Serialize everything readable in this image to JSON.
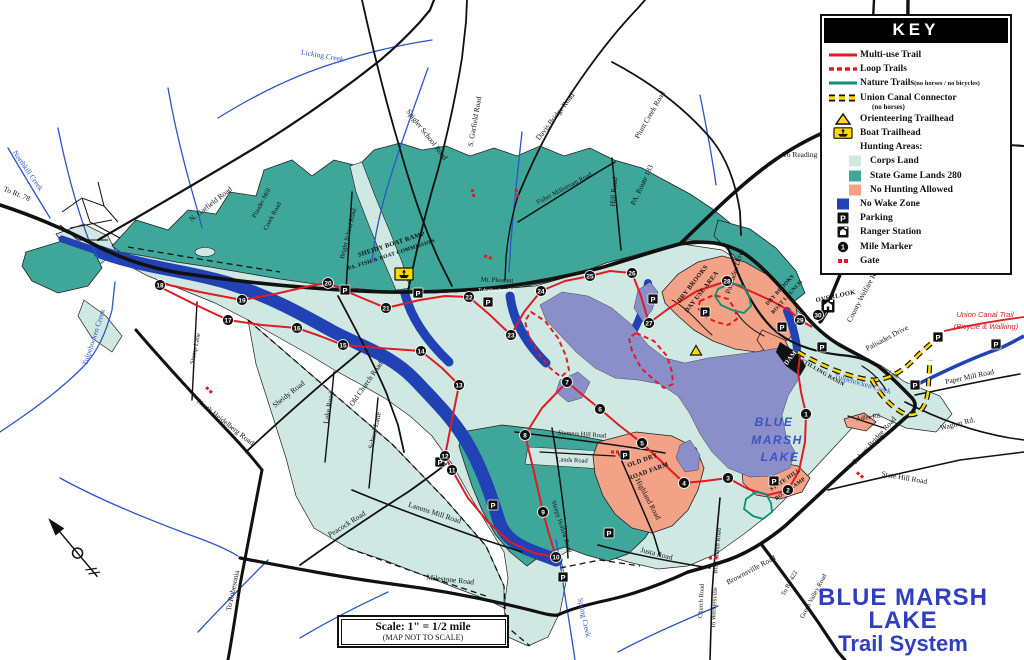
{
  "title": {
    "line1": "BLUE MARSH",
    "line2": "LAKE",
    "line3": "Trail System"
  },
  "scale_box": {
    "line1": "Scale:  1\" = 1/2 mile",
    "line2": "(MAP NOT TO SCALE)"
  },
  "key": {
    "title": "KEY",
    "items": [
      {
        "type": "line-red",
        "label": "Multi-use Trail"
      },
      {
        "type": "line-dash",
        "label": "Loop Trails"
      },
      {
        "type": "line-teal",
        "label": "Nature Trails",
        "note": "(no horses / no bicycles)",
        "note_inline": true
      },
      {
        "type": "line-canal",
        "label": "Union Canal Connector",
        "note": "(no horses)",
        "note_below": true
      },
      {
        "type": "tri",
        "label": "Orienteering Trailhead"
      },
      {
        "type": "boat",
        "label": "Boat Trailhead"
      },
      {
        "type": "none",
        "label": "Hunting Areas:"
      },
      {
        "type": "sw-pale",
        "label": "Corps Land",
        "indent": true
      },
      {
        "type": "sw-teal",
        "label": "State Game Lands 280",
        "indent": true
      },
      {
        "type": "sw-salmon",
        "label": "No Hunting Allowed",
        "indent": true
      },
      {
        "type": "sw-blue",
        "label": "No Wake Zone"
      },
      {
        "type": "parking",
        "label": "Parking"
      },
      {
        "type": "ranger",
        "label": "Ranger Station"
      },
      {
        "type": "mile",
        "label": "Mile Marker"
      },
      {
        "type": "gate",
        "label": "Gate"
      }
    ]
  },
  "colors": {
    "corps_land": "#cfe8e2",
    "state_game_lands": "#3fa79a",
    "no_hunting": "#f2a287",
    "lake": "#8a8fca",
    "no_wake_zone": "#2042b4",
    "creek": "#2b55c8",
    "road": "#111111",
    "multi_use_trail": "#e11b24",
    "nature_trail": "#0d9077",
    "canal_yellow": "#ffd900",
    "title_blue": "#2f3fc0"
  },
  "map": {
    "labels": [
      {
        "t": "To Rt. 78",
        "x": 16,
        "y": 196,
        "r": 22,
        "c": "road"
      },
      {
        "t": "N. Garfield Road",
        "x": 212,
        "y": 206,
        "r": -38,
        "c": "road"
      },
      {
        "t": "Plauder Mill",
        "x": 263,
        "y": 204,
        "r": -62,
        "c": "road",
        "s": 6.5
      },
      {
        "t": "Creek Road",
        "x": 274,
        "y": 217,
        "r": -62,
        "c": "road",
        "s": 6.5
      },
      {
        "t": "Bright School Road",
        "x": 350,
        "y": 234,
        "r": -76,
        "c": "road",
        "s": 6.5
      },
      {
        "t": "Spigler School Road",
        "x": 425,
        "y": 136,
        "r": 52,
        "c": "road"
      },
      {
        "t": "S. Garfield Road",
        "x": 477,
        "y": 122,
        "r": -80,
        "c": "road"
      },
      {
        "t": "Davis Bridge Road",
        "x": 557,
        "y": 118,
        "r": -52,
        "c": "road"
      },
      {
        "t": "Plum Creek Road",
        "x": 652,
        "y": 116,
        "r": -60,
        "c": "road"
      },
      {
        "t": "Fisher Millstream Road",
        "x": 565,
        "y": 190,
        "r": -28,
        "c": "road",
        "s": 6.5
      },
      {
        "t": "Hill Road",
        "x": 616,
        "y": 192,
        "r": -85,
        "c": "road"
      },
      {
        "t": "PA. Route 183",
        "x": 644,
        "y": 186,
        "r": -65,
        "c": "road"
      },
      {
        "t": "To Reading",
        "x": 800,
        "y": 157,
        "r": 0,
        "c": "road"
      },
      {
        "t": "Mt. Pleasant",
        "x": 497,
        "y": 282,
        "r": 2,
        "c": "road",
        "s": 6.5
      },
      {
        "t": "Tulpehocken Rd.",
        "x": 497,
        "y": 292,
        "r": 0,
        "c": "tinyw"
      },
      {
        "t": "Palisades Drive",
        "x": 737,
        "y": 272,
        "r": -72,
        "c": "road"
      },
      {
        "t": "Palisades Drive",
        "x": 888,
        "y": 340,
        "r": -28,
        "c": "road"
      },
      {
        "t": "County Welfare Road",
        "x": 866,
        "y": 294,
        "r": -62,
        "c": "road"
      },
      {
        "t": "Paper Mill Road",
        "x": 970,
        "y": 379,
        "r": -12,
        "c": "road"
      },
      {
        "t": "Sweitzer Lane",
        "x": 884,
        "y": 371,
        "r": 28,
        "c": "road",
        "s": 5.5
      },
      {
        "t": "Wagner Rd.",
        "x": 958,
        "y": 426,
        "r": -14,
        "c": "road"
      },
      {
        "t": "Adler Rd.",
        "x": 869,
        "y": 419,
        "r": -8,
        "c": "road",
        "s": 6.5
      },
      {
        "t": "Rebers Bridge Road",
        "x": 876,
        "y": 442,
        "r": -48,
        "c": "road"
      },
      {
        "t": "State Hill Road",
        "x": 904,
        "y": 480,
        "r": 10,
        "c": "road"
      },
      {
        "t": "Stump Lane",
        "x": 197,
        "y": 349,
        "r": -78,
        "c": "road",
        "s": 6.5
      },
      {
        "t": "Sheidy Road",
        "x": 290,
        "y": 396,
        "r": -38,
        "c": "road"
      },
      {
        "t": "Old Church Road",
        "x": 368,
        "y": 385,
        "r": -55,
        "c": "road"
      },
      {
        "t": "Lake Road",
        "x": 331,
        "y": 408,
        "r": -80,
        "c": "road"
      },
      {
        "t": "School Lane",
        "x": 377,
        "y": 431,
        "r": -78,
        "c": "road"
      },
      {
        "t": "North Heidelberg Road",
        "x": 224,
        "y": 424,
        "r": 38,
        "c": "road"
      },
      {
        "t": "Peacock Road",
        "x": 348,
        "y": 526,
        "r": -32,
        "c": "road"
      },
      {
        "t": "To Robesonia",
        "x": 235,
        "y": 591,
        "r": -78,
        "c": "road"
      },
      {
        "t": "Milestone Road",
        "x": 450,
        "y": 582,
        "r": 6,
        "c": "road"
      },
      {
        "t": "Lamms Mill Road",
        "x": 434,
        "y": 515,
        "r": 18,
        "c": "road"
      },
      {
        "t": "Sleepy Hollow Road",
        "x": 560,
        "y": 527,
        "r": 72,
        "c": "road",
        "s": 6.5
      },
      {
        "t": "Stemers Hill Road",
        "x": 582,
        "y": 436,
        "r": 4,
        "c": "road",
        "s": 6.5
      },
      {
        "t": "Lands Road",
        "x": 572,
        "y": 462,
        "r": 3,
        "c": "road",
        "s": 6.5
      },
      {
        "t": "Highland Road",
        "x": 646,
        "y": 500,
        "r": 62,
        "c": "road"
      },
      {
        "t": "Justa Road",
        "x": 656,
        "y": 556,
        "r": 14,
        "c": "road"
      },
      {
        "t": "Blue Marsh Road",
        "x": 719,
        "y": 551,
        "r": -85,
        "c": "road",
        "s": 6.5
      },
      {
        "t": "Brownsville Road",
        "x": 752,
        "y": 572,
        "r": -28,
        "c": "road"
      },
      {
        "t": "To Rt. 422",
        "x": 791,
        "y": 584,
        "r": -62,
        "c": "road",
        "s": 6.5
      },
      {
        "t": "Green Valley Road",
        "x": 815,
        "y": 597,
        "r": -62,
        "c": "road",
        "s": 6.5
      },
      {
        "t": "Church Road",
        "x": 703,
        "y": 601,
        "r": -87,
        "c": "road",
        "s": 6.5
      },
      {
        "t": "To Wernersville",
        "x": 716,
        "y": 608,
        "r": -87,
        "c": "road",
        "s": 6.5
      },
      {
        "t": "Licking Creek",
        "x": 322,
        "y": 58,
        "r": 10,
        "c": "creek"
      },
      {
        "t": "Northkill Creek",
        "x": 26,
        "y": 172,
        "r": 55,
        "c": "creek"
      },
      {
        "t": "Tulpehocken Creek",
        "x": 96,
        "y": 338,
        "r": -72,
        "c": "creek"
      },
      {
        "t": "Spring Creek",
        "x": 582,
        "y": 618,
        "r": 78,
        "c": "creek"
      },
      {
        "t": "Tulpehocken Creek",
        "x": 862,
        "y": 386,
        "r": 16,
        "c": "creek"
      },
      {
        "t": "SHEIDY BOAT RAMP",
        "x": 392,
        "y": 246,
        "r": -18,
        "c": "area"
      },
      {
        "t": "PA. FISH & BOAT COMMISSION",
        "x": 392,
        "y": 256,
        "r": -18,
        "c": "area",
        "s": 5.5
      },
      {
        "t": "DRY BROOKS",
        "x": 694,
        "y": 285,
        "r": -52,
        "c": "area"
      },
      {
        "t": "DAY USE AREA",
        "x": 703,
        "y": 293,
        "r": -52,
        "c": "area"
      },
      {
        "t": "DRY BROOKS",
        "x": 781,
        "y": 291,
        "r": -48,
        "c": "area",
        "s": 5.5
      },
      {
        "t": "BOAT LAUNCH",
        "x": 788,
        "y": 298,
        "r": -48,
        "c": "area",
        "s": 5.5
      },
      {
        "t": "OVERLOOK",
        "x": 836,
        "y": 298,
        "r": -12,
        "c": "area"
      },
      {
        "t": "STILLING BASIN",
        "x": 822,
        "y": 374,
        "r": 30,
        "c": "area",
        "s": 5.5
      },
      {
        "t": "OLD DRY",
        "x": 643,
        "y": 462,
        "r": -20,
        "c": "area"
      },
      {
        "t": "ROAD FARM",
        "x": 649,
        "y": 473,
        "r": -20,
        "c": "area"
      },
      {
        "t": "STATE HILL",
        "x": 786,
        "y": 481,
        "r": -35,
        "c": "area",
        "s": 5.5
      },
      {
        "t": "BOAT RAMP",
        "x": 791,
        "y": 490,
        "r": -35,
        "c": "area",
        "s": 5.5
      },
      {
        "t": "DAM",
        "x": 792,
        "y": 359,
        "r": -52,
        "c": "areaw"
      },
      {
        "t": "BLUE",
        "x": 774,
        "y": 426,
        "r": 0,
        "c": "lake"
      },
      {
        "t": "MARSH",
        "x": 777,
        "y": 444,
        "r": 0,
        "c": "lake"
      },
      {
        "t": "LAKE",
        "x": 780,
        "y": 461,
        "r": 0,
        "c": "lake"
      },
      {
        "t": "Union Canal Trail",
        "x": 985,
        "y": 317,
        "r": 0,
        "c": "canal"
      },
      {
        "t": "(Bicycle & Walking)",
        "x": 986,
        "y": 329,
        "r": 0,
        "c": "canal"
      }
    ],
    "mile_markers": [
      {
        "n": "1",
        "x": 806,
        "y": 414
      },
      {
        "n": "2",
        "x": 788,
        "y": 490
      },
      {
        "n": "3",
        "x": 728,
        "y": 478
      },
      {
        "n": "4",
        "x": 684,
        "y": 483
      },
      {
        "n": "5",
        "x": 642,
        "y": 443
      },
      {
        "n": "6",
        "x": 600,
        "y": 409
      },
      {
        "n": "7",
        "x": 567,
        "y": 382
      },
      {
        "n": "8",
        "x": 525,
        "y": 435
      },
      {
        "n": "9",
        "x": 543,
        "y": 512
      },
      {
        "n": "10",
        "x": 556,
        "y": 557
      },
      {
        "n": "11",
        "x": 452,
        "y": 470
      },
      {
        "n": "12",
        "x": 445,
        "y": 456
      },
      {
        "n": "13",
        "x": 459,
        "y": 385
      },
      {
        "n": "14",
        "x": 421,
        "y": 351
      },
      {
        "n": "15",
        "x": 343,
        "y": 345
      },
      {
        "n": "16",
        "x": 297,
        "y": 328
      },
      {
        "n": "17",
        "x": 228,
        "y": 320
      },
      {
        "n": "18",
        "x": 160,
        "y": 285
      },
      {
        "n": "19",
        "x": 242,
        "y": 300
      },
      {
        "n": "20",
        "x": 328,
        "y": 283
      },
      {
        "n": "21",
        "x": 386,
        "y": 308
      },
      {
        "n": "22",
        "x": 469,
        "y": 297
      },
      {
        "n": "23",
        "x": 511,
        "y": 335
      },
      {
        "n": "24",
        "x": 541,
        "y": 291
      },
      {
        "n": "25",
        "x": 590,
        "y": 276
      },
      {
        "n": "26",
        "x": 632,
        "y": 273
      },
      {
        "n": "27",
        "x": 649,
        "y": 323
      },
      {
        "n": "28",
        "x": 727,
        "y": 281
      },
      {
        "n": "29",
        "x": 800,
        "y": 320
      },
      {
        "n": "30",
        "x": 818,
        "y": 315
      }
    ],
    "parking": [
      {
        "x": 345,
        "y": 290
      },
      {
        "x": 418,
        "y": 293
      },
      {
        "x": 488,
        "y": 302
      },
      {
        "x": 653,
        "y": 299
      },
      {
        "x": 705,
        "y": 312
      },
      {
        "x": 782,
        "y": 327
      },
      {
        "x": 822,
        "y": 347
      },
      {
        "x": 938,
        "y": 337
      },
      {
        "x": 915,
        "y": 385
      },
      {
        "x": 996,
        "y": 344
      },
      {
        "x": 625,
        "y": 455
      },
      {
        "x": 774,
        "y": 481
      },
      {
        "x": 493,
        "y": 505
      },
      {
        "x": 609,
        "y": 533
      },
      {
        "x": 563,
        "y": 577
      },
      {
        "x": 440,
        "y": 462
      }
    ],
    "gates": [
      {
        "x": 473,
        "y": 193,
        "r": 75
      },
      {
        "x": 517,
        "y": 193,
        "r": 75
      },
      {
        "x": 488,
        "y": 257,
        "r": 20
      },
      {
        "x": 860,
        "y": 475,
        "r": 40
      },
      {
        "x": 615,
        "y": 452,
        "r": 0
      },
      {
        "x": 713,
        "y": 558,
        "r": 0
      },
      {
        "x": 209,
        "y": 390,
        "r": 45
      }
    ],
    "orienteering_trailheads": [
      {
        "x": 696,
        "y": 351
      }
    ],
    "boat_trailheads": [
      {
        "x": 404,
        "y": 274
      }
    ],
    "ranger_stations": [
      {
        "x": 828,
        "y": 306
      }
    ]
  }
}
